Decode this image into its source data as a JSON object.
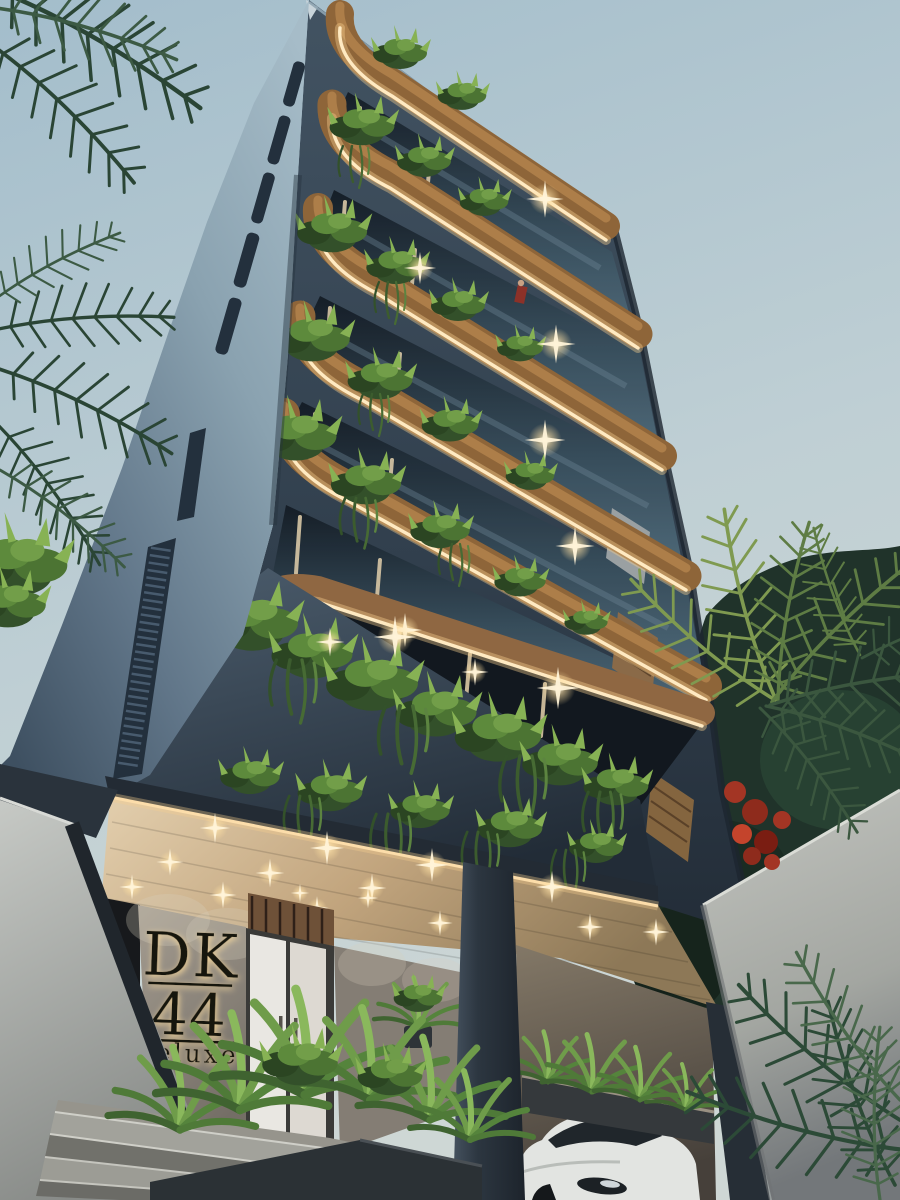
{
  "scene": {
    "setting": "Modern residential tower with planted balconies at dusk",
    "view": "low-angle street-level view"
  },
  "signage": {
    "line1": "DK",
    "line2": "44",
    "line3": "deluxe"
  },
  "building": {
    "balcony_rows": 6,
    "balcony_lighting": "warm LED strips and recessed downlights",
    "facade_material": "dark blue-grey panels with wood soffits"
  },
  "entities": {
    "woman": "woman with shopping bag at entrance",
    "balcony_person": "small figure on upper balcony",
    "vehicle": "white sedan in lower driveway",
    "vegetation": "palms, ferns and cascading balcony plants, red bougainvillea"
  },
  "palette": {
    "sky_top": "#a5bfcc",
    "sky_bottom": "#ccd6d5",
    "left_wall": "#87a0ae",
    "facade": "#32404e",
    "wood_band": "#8e6539",
    "led_glow": "#ffeac2",
    "canopy_wood": "#d7c3a4",
    "foliage_dark": "#2a4535",
    "foliage_light": "#6f9c4a",
    "bougainvillea": "#a33524",
    "concrete": "#b5b8b4",
    "planter": "#2b3135",
    "car": "#e2e4e1",
    "sign_letters": "#18120c",
    "sign_backlight": "#ffdf9e"
  }
}
